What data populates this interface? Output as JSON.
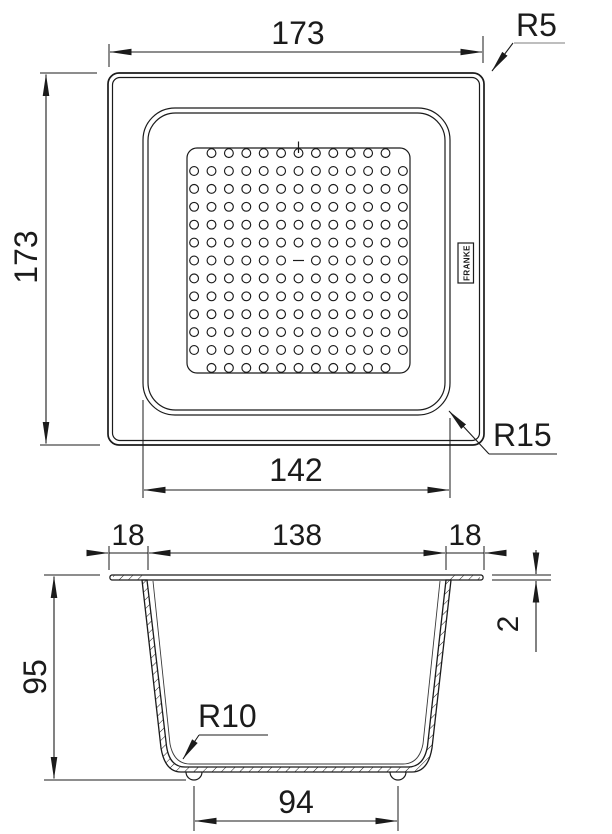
{
  "dimensions": {
    "overall_width": "173",
    "overall_height": "173",
    "outer_corner_radius": "R5",
    "inner_corner_radius": "R15",
    "rim_width": "142",
    "flange_left": "18",
    "opening_width": "138",
    "flange_right": "18",
    "rim_thickness": "2",
    "depth": "95",
    "base_corner_radius": "R10",
    "base_width": "94"
  },
  "logo": {
    "text": "FRANKE"
  },
  "perforation": {
    "rows": 13,
    "cols": 13,
    "skips": [
      [
        0,
        0
      ],
      [
        0,
        12
      ],
      [
        6,
        6
      ],
      [
        12,
        0
      ],
      [
        12,
        12
      ]
    ],
    "center_mark": true
  },
  "colors": {
    "line": "#1b1b1b",
    "leader_underline": "#a9a9a9",
    "background": "#ffffff"
  }
}
